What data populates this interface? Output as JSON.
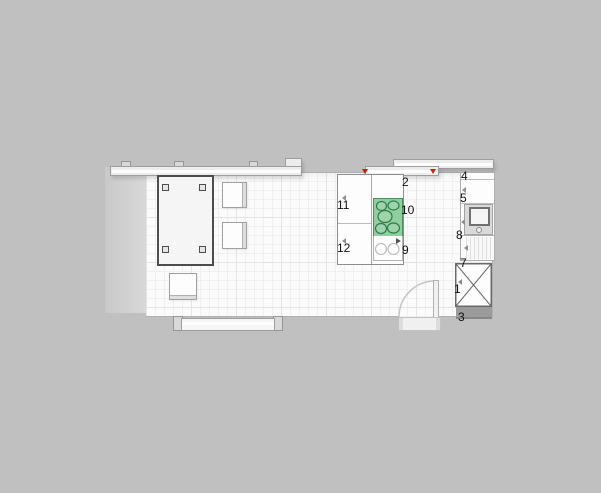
{
  "app": {
    "view": "kitchen-floorplan-top-view",
    "background_color": "#c0c0c0"
  },
  "colors": {
    "floor": "#fbfbfb",
    "grid_minor": "#f0f0f0",
    "grid_major": "#e4e4e4",
    "cooktop_green_fill": "#92cfa0",
    "cooktop_burner_stroke": "#2e7c46",
    "selection_marker_red": "#cc2200",
    "wall_gray": "#b0b0b0",
    "label_color": "#111111"
  },
  "selection": {
    "selected_item_id": "2",
    "marker_count": 2
  },
  "item_labels": [
    {
      "id": "1",
      "x": 454,
      "y": 283
    },
    {
      "id": "2",
      "x": 402,
      "y": 176
    },
    {
      "id": "3",
      "x": 458,
      "y": 311
    },
    {
      "id": "4",
      "x": 461,
      "y": 170
    },
    {
      "id": "5",
      "x": 460,
      "y": 192
    },
    {
      "id": "7",
      "x": 460,
      "y": 257
    },
    {
      "id": "8",
      "x": 456,
      "y": 229
    },
    {
      "id": "9",
      "x": 402,
      "y": 244
    },
    {
      "id": "10",
      "x": 401,
      "y": 204
    },
    {
      "id": "11",
      "x": 337,
      "y": 199
    },
    {
      "id": "12",
      "x": 337,
      "y": 242
    }
  ],
  "objects": {
    "dining_table": {
      "label": "",
      "legs": 4
    },
    "chairs": 3,
    "island_cabinets": [
      "11",
      "12"
    ],
    "cooktop_burners": 5,
    "island_sink_basins": 2,
    "windows_top": 3,
    "window_bottom": 1,
    "door_swing": "quarter-arc",
    "tall_cabinet_marking": "X"
  }
}
